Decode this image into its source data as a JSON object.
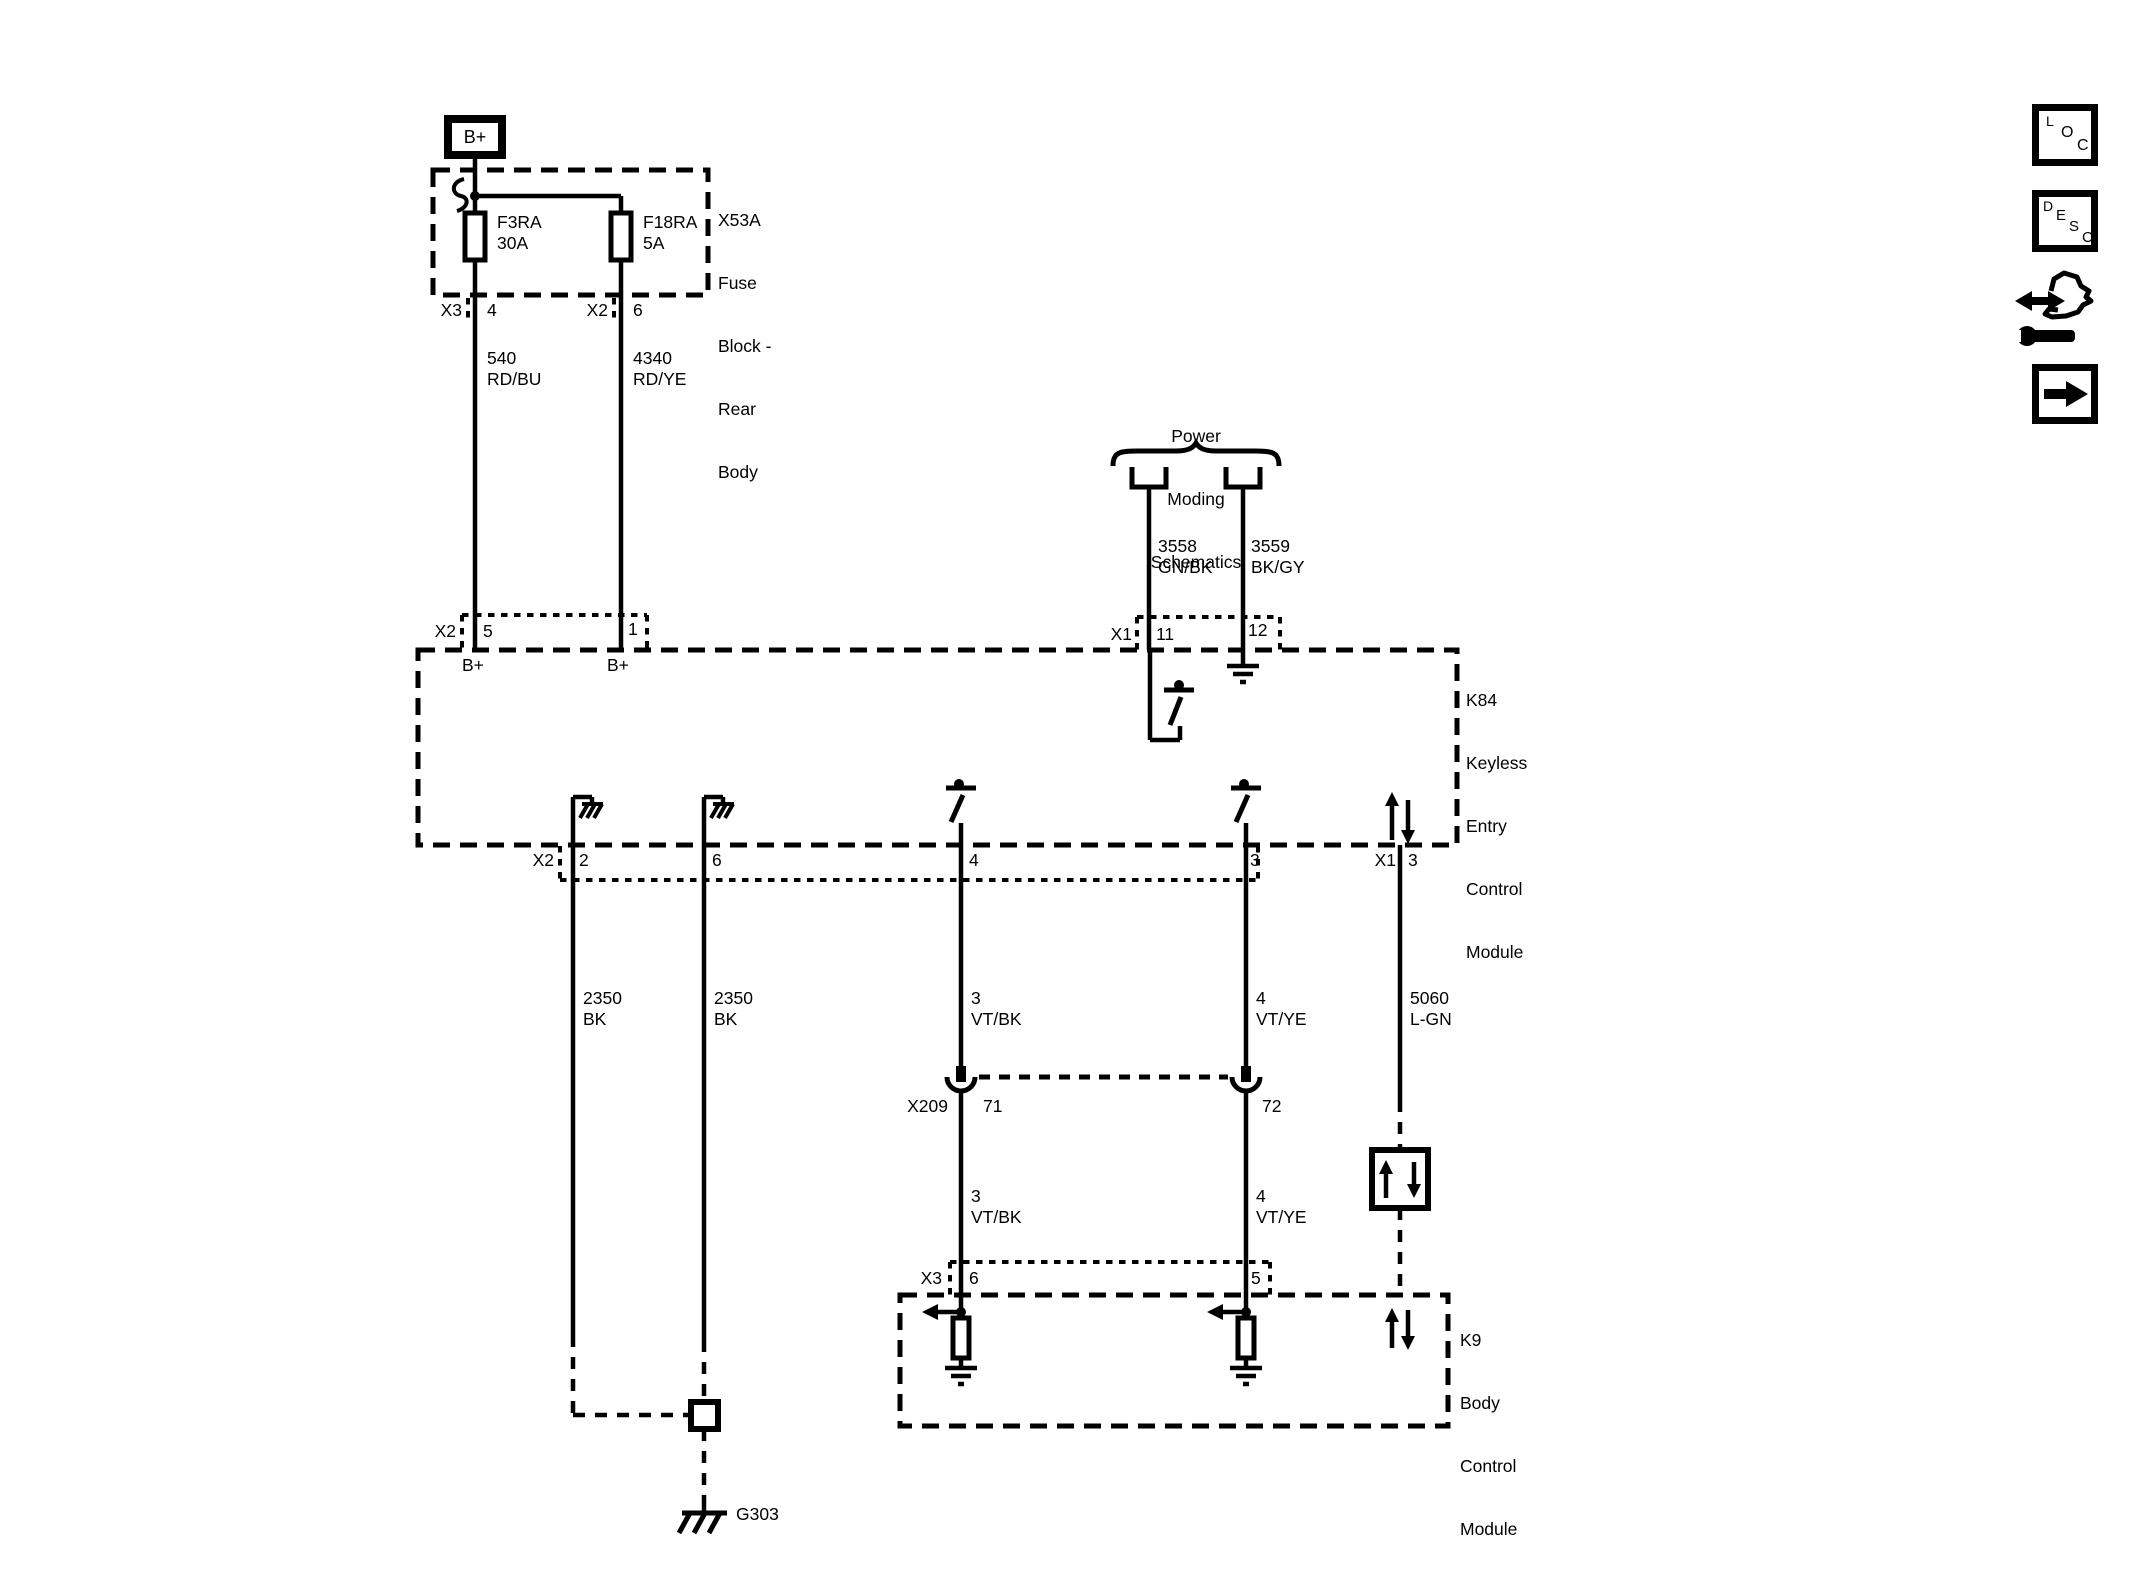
{
  "colors": {
    "line": "#000000",
    "background": "#ffffff"
  },
  "battery": {
    "label": "B+"
  },
  "fuse_block": {
    "name_lines": [
      "X53A",
      "Fuse",
      "Block -",
      "Rear",
      "Body"
    ],
    "fuse1": {
      "id": "F3RA",
      "rating": "30A"
    },
    "fuse2": {
      "id": "F18RA",
      "rating": "5A"
    },
    "pin_row": {
      "conn1": "X3",
      "pin1": "4",
      "conn2": "X2",
      "pin2": "6"
    }
  },
  "wires": {
    "w540": {
      "circuit": "540",
      "color_code": "RD/BU"
    },
    "w4340": {
      "circuit": "4340",
      "color_code": "RD/YE"
    },
    "w3558": {
      "circuit": "3558",
      "color_code": "GN/BK"
    },
    "w3559": {
      "circuit": "3559",
      "color_code": "BK/GY"
    },
    "w2350_left": {
      "circuit": "2350",
      "color_code": "BK"
    },
    "w2350_right": {
      "circuit": "2350",
      "color_code": "BK"
    },
    "w3_upper": {
      "circuit": "3",
      "color_code": "VT/BK"
    },
    "w4_upper": {
      "circuit": "4",
      "color_code": "VT/YE"
    },
    "w5060": {
      "circuit": "5060",
      "color_code": "L-GN"
    },
    "w3_lower": {
      "circuit": "3",
      "color_code": "VT/BK"
    },
    "w4_lower": {
      "circuit": "4",
      "color_code": "VT/YE"
    }
  },
  "references": {
    "power_moding_lines": [
      "Power",
      "Moding",
      "Schematics"
    ]
  },
  "k84": {
    "name_lines": [
      "K84",
      "Keyless",
      "Entry",
      "Control",
      "Module"
    ],
    "top_left_row": {
      "conn": "X2",
      "pin_a": "5",
      "pin_b": "1",
      "label_a": "B+",
      "label_b": "B+"
    },
    "top_right_row": {
      "conn": "X1",
      "pin_a": "11",
      "pin_b": "12"
    },
    "bottom_row": {
      "conn": "X2",
      "pin_a": "2",
      "pin_b": "6",
      "pin_c": "4",
      "pin_d": "3"
    },
    "bottom_right_row": {
      "conn": "X1",
      "pin": "3"
    }
  },
  "x209": {
    "name": "X209",
    "pin_a": "71",
    "pin_b": "72"
  },
  "k9": {
    "name_lines": [
      "K9",
      "Body",
      "Control",
      "Module"
    ],
    "pin_row": {
      "conn": "X3",
      "pin_a": "6",
      "pin_b": "5"
    }
  },
  "grounds": {
    "g303": "G303"
  },
  "sidebar": {
    "loc_letters": [
      "L",
      "O",
      "C"
    ],
    "desc_letters": [
      "D",
      "E",
      "S",
      "C"
    ]
  }
}
